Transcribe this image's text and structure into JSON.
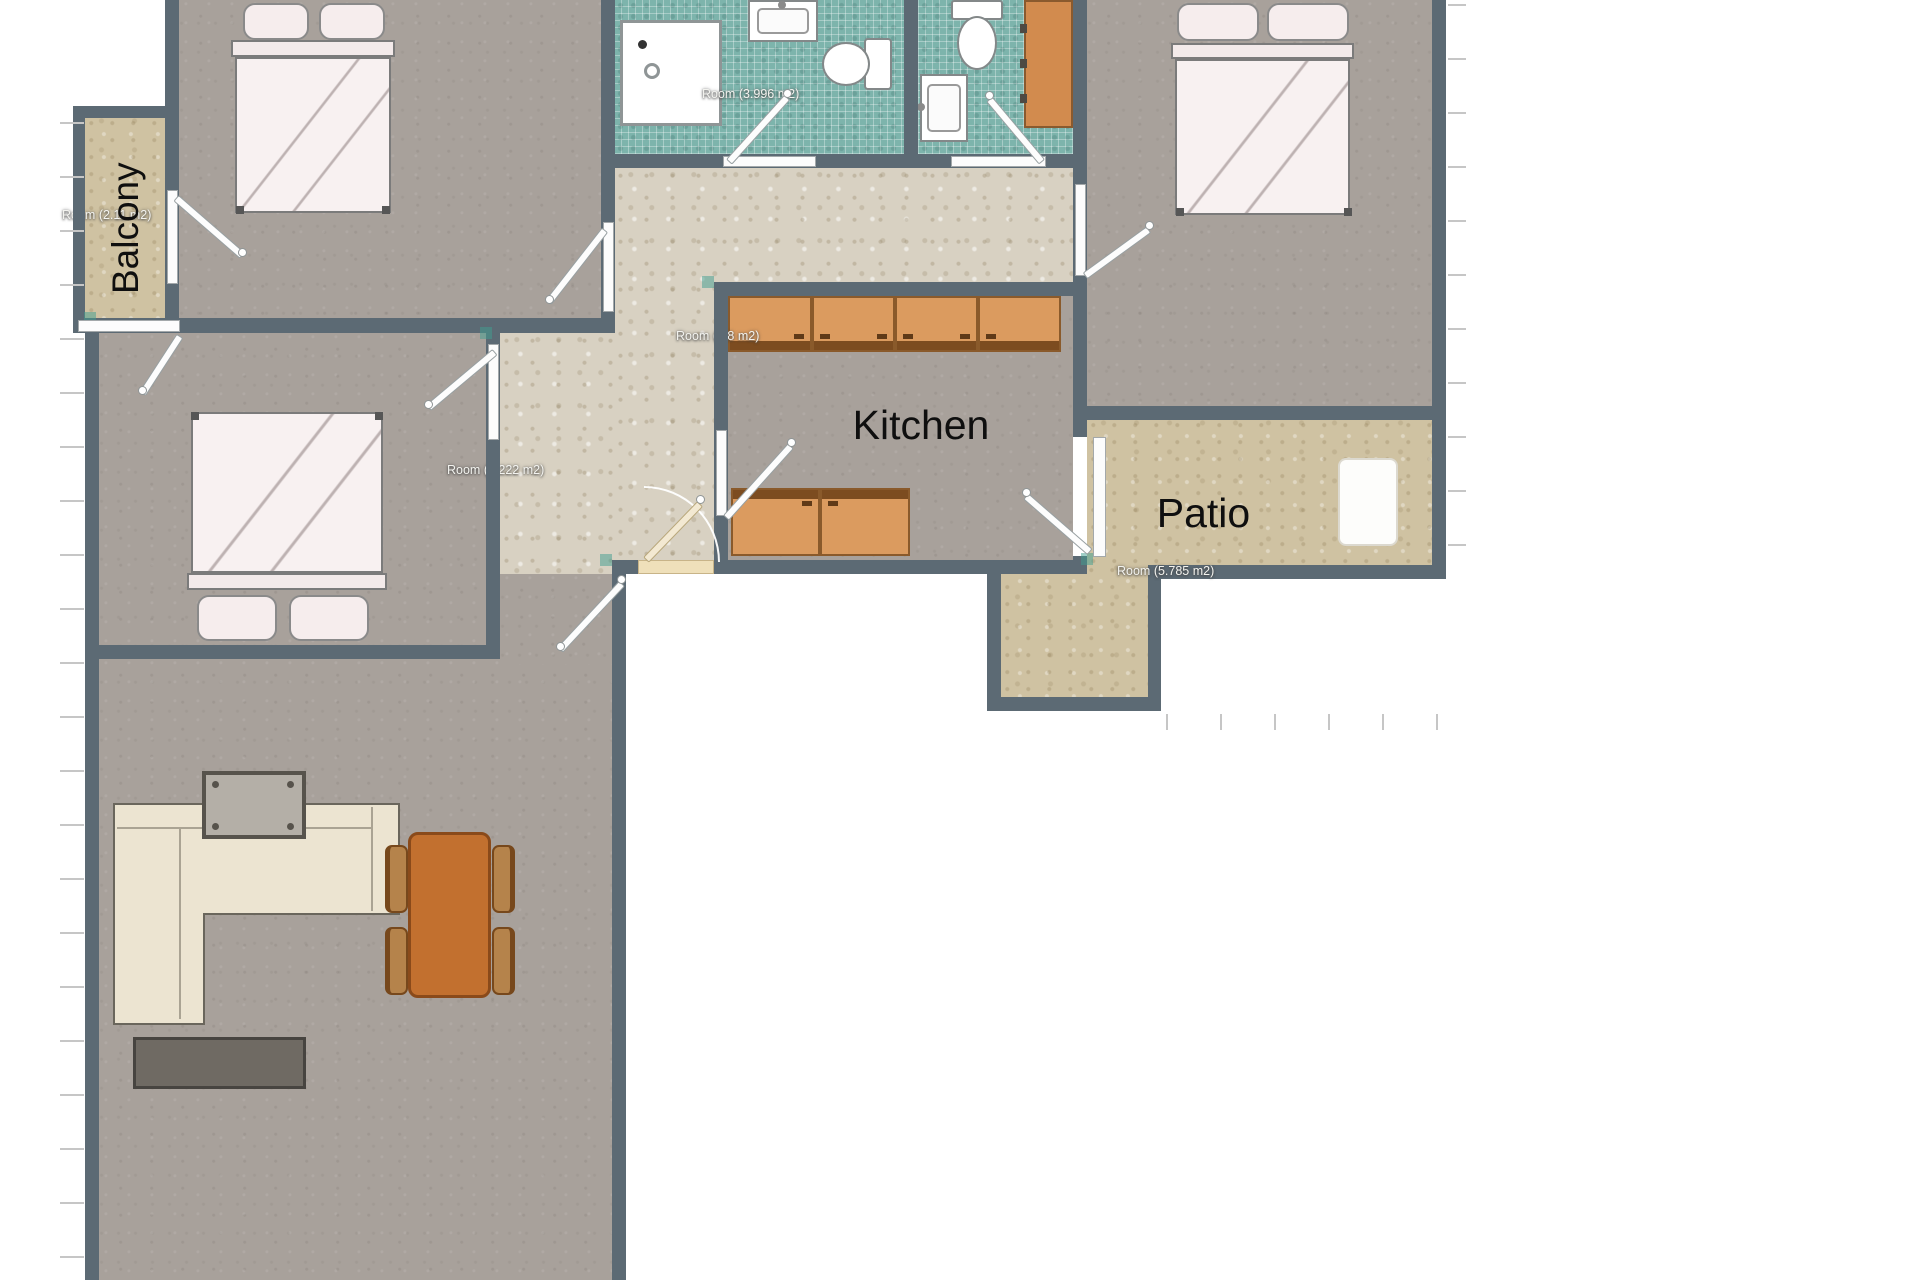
{
  "labels": {
    "balcony": "Balcony",
    "kitchen": "Kitchen",
    "patio": "Patio"
  },
  "room_tags": {
    "balcony": "Room (2.11 m2)",
    "bedroom_left": "Room (9.222 m2)",
    "bathroom_main": "Room (3.996 m2)",
    "kitchen": "Room (7.8 m2)",
    "patio": "Room (5.785 m2)"
  },
  "colors": {
    "wall": "#5c6a74",
    "floor_room": "#a8a19b",
    "floor_hall": "#d8d1c2",
    "floor_outdoor": "#cfc2a2",
    "floor_bath": "#7db4ac",
    "cabinet": "#db9b5f",
    "cabinet_edge": "#7c4c20",
    "table": "#c2702f",
    "chair": "#b5834b",
    "sofa": "#ece4d1",
    "bed": "#f8f1f1",
    "accent_snap": "#3f9e8f"
  }
}
